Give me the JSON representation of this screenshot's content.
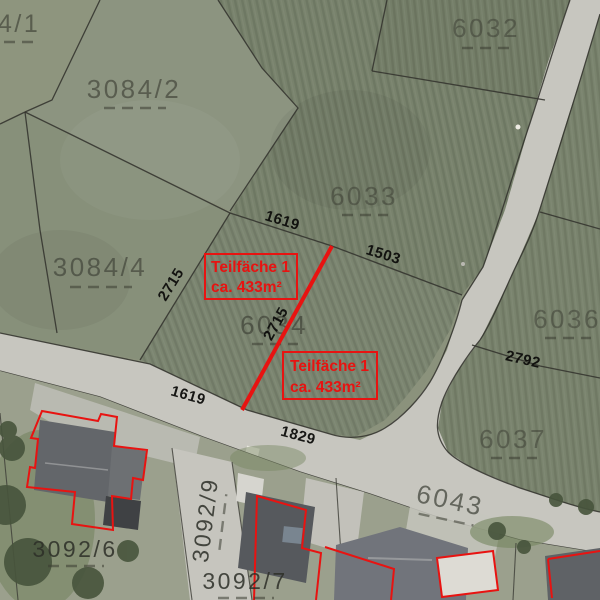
{
  "annotations": {
    "red_hex": "#e81311",
    "box1": {
      "line1": "Teilfäche 1",
      "line2": "ca. 433m²"
    },
    "box2": {
      "line1": "Teilfäche 1",
      "line2": "ca. 433m²"
    }
  },
  "parcel_labels": {
    "p3084_1": "4/1",
    "p3084_2": "3084/2",
    "p3084_4": "3084/4",
    "p6032": "6032",
    "p6033": "6033",
    "p6034": "6034",
    "p6036": "6036",
    "p6037": "6037",
    "p6043": "6043",
    "p3092_6": "3092/6",
    "p3092_7": "3092/7",
    "p3092_9": "3092/9"
  },
  "measurements": {
    "seg_1619_north": "1619",
    "seg_1503": "1503",
    "seg_2715_west": "2715",
    "seg_2715_split": "2715",
    "seg_1619_road": "1619",
    "seg_1829": "1829",
    "seg_2792": "2792"
  }
}
